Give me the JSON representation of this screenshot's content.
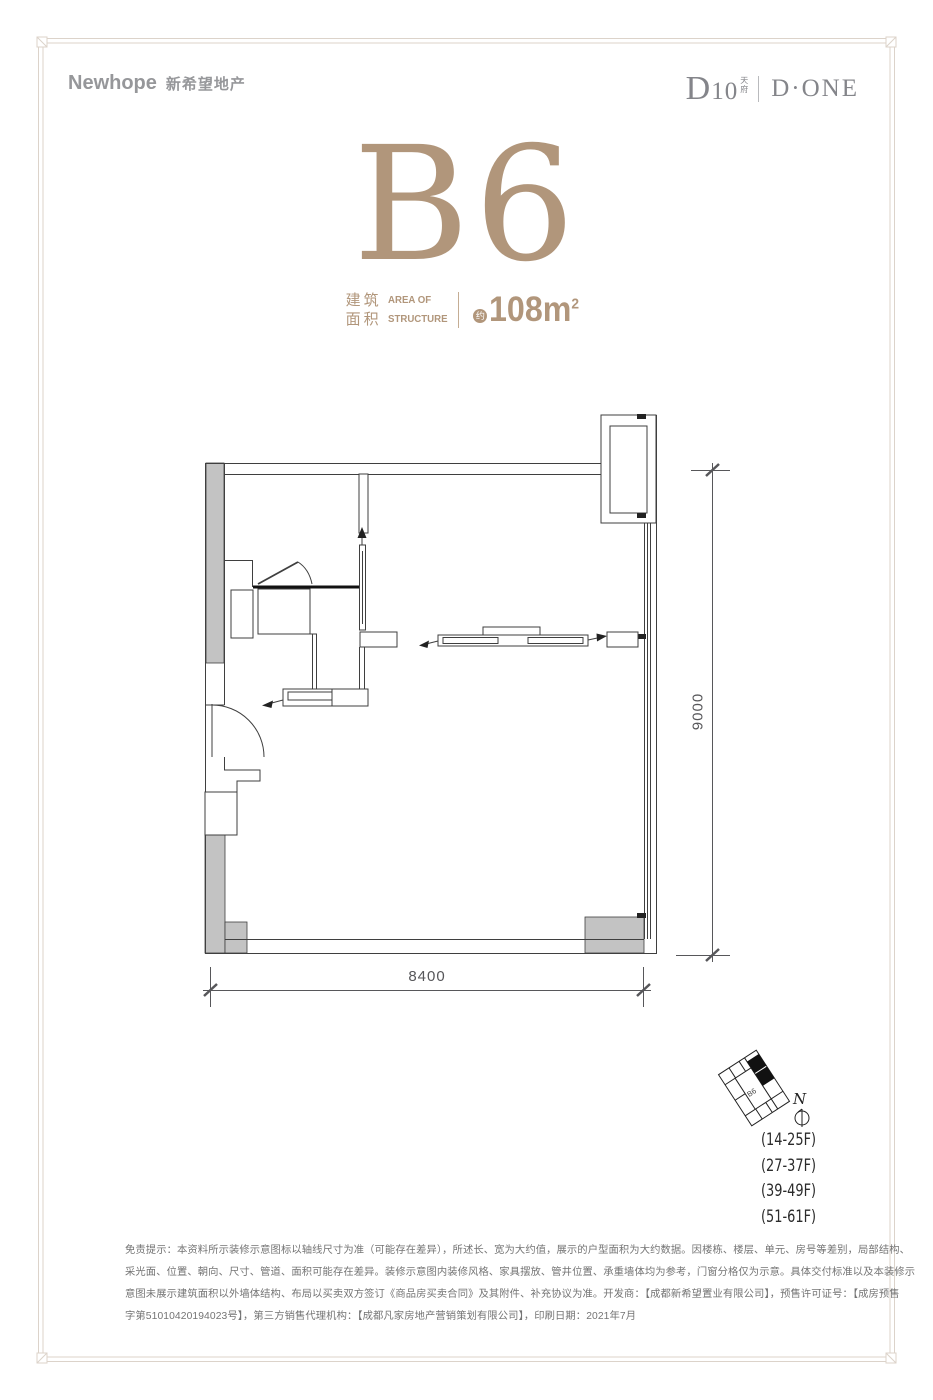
{
  "header": {
    "brand_left": {
      "name": "Newhope",
      "cn": "新希望地产"
    },
    "brand_right": {
      "d10": "D10",
      "d10_sub_top": "天",
      "d10_sub_bottom": "府",
      "done": "D·ONE"
    }
  },
  "unit": {
    "title": "B6",
    "area_label_cn_line1": "建筑",
    "area_label_cn_line2": "面积",
    "area_label_en_line1": "AREA OF",
    "area_label_en_line2": "STRUCTURE",
    "approx_badge": "约",
    "area_value": "108m",
    "area_sup": "2"
  },
  "floorplan": {
    "dim_width": "8400",
    "dim_height": "9000"
  },
  "keyplan": {
    "unit_label": "B6",
    "north_label": "N",
    "floors": [
      "(14-25F)",
      "(27-37F)",
      "(39-49F)",
      "(51-61F)"
    ]
  },
  "disclaimer": {
    "lines": [
      "免责提示：本资料所示装修示意图标以轴线尺寸为准（可能存在差异），所述长、宽为大约值，展示的户型面积为大约数据。因楼栋、楼层、单元、房号等差别，局部结构、",
      "采光面、位置、朝向、尺寸、管道、面积可能存在差异。装修示意图内装修风格、家具摆放、管井位置、承重墙体均为参考，门窗分格仅为示意。具体交付标准以及本装修示",
      "意图未展示建筑面积以外墙体结构、布局以买卖双方签订《商品房买卖合同》及其附件、补充协议为准。开发商：【成都新希望置业有限公司】，预售许可证号：【成房预售",
      "字第51010420194023号】，第三方销售代理机构：【成都凡家房地产营销策划有限公司】，印刷日期：2021年7月"
    ]
  },
  "colors": {
    "accent_tan": "#b1967b",
    "logo_gray": "#96979a",
    "plan_line": "#3f3f3f",
    "gray_fill": "#c3c3c3",
    "frame": "#dcd3ca",
    "text_gray": "#747474"
  }
}
